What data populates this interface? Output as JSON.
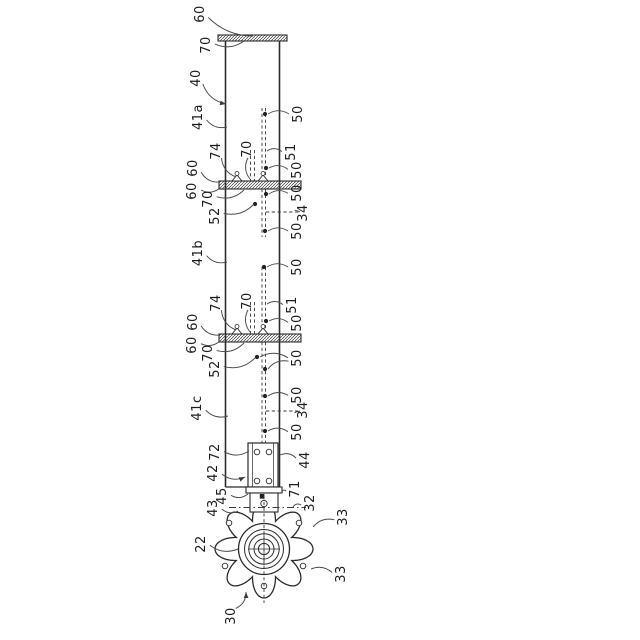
{
  "figure": {
    "kind": "patent-line-drawing",
    "orientation_note": "reference numerals rotated 90deg CCW",
    "background": "#ffffff",
    "line_color": "#2b2b2b",
    "leader_color": "#4a4a4a"
  },
  "labels": [
    {
      "t": "60",
      "x": 200,
      "y": 14,
      "tx": 253,
      "ty": 36
    },
    {
      "t": "70",
      "x": 206,
      "y": 45,
      "tx": 244,
      "ty": 41
    },
    {
      "t": "40",
      "x": 196,
      "y": 78,
      "tx": 226,
      "ty": 104,
      "arrow": true
    },
    {
      "t": "41a",
      "x": 198,
      "y": 117,
      "tx": 227,
      "ty": 127
    },
    {
      "t": "74",
      "x": 216,
      "y": 151,
      "tx": 236,
      "ty": 177
    },
    {
      "t": "70",
      "x": 247,
      "y": 149,
      "tx": 250,
      "ty": 179
    },
    {
      "t": "60",
      "x": 193,
      "y": 168,
      "tx": 220,
      "ty": 182
    },
    {
      "t": "60",
      "x": 192,
      "y": 191,
      "tx": 220,
      "ty": 188
    },
    {
      "t": "70",
      "x": 208,
      "y": 199,
      "tx": 244,
      "ty": 190
    },
    {
      "t": "52",
      "x": 215,
      "y": 216,
      "tx": 254,
      "ty": 204
    },
    {
      "t": "41b",
      "x": 198,
      "y": 253,
      "tx": 227,
      "ty": 262
    },
    {
      "t": "74",
      "x": 216,
      "y": 303,
      "tx": 236,
      "ty": 330
    },
    {
      "t": "70",
      "x": 247,
      "y": 301,
      "tx": 250,
      "ty": 332
    },
    {
      "t": "60",
      "x": 193,
      "y": 322,
      "tx": 220,
      "ty": 335
    },
    {
      "t": "60",
      "x": 192,
      "y": 345,
      "tx": 220,
      "ty": 341
    },
    {
      "t": "70",
      "x": 208,
      "y": 353,
      "tx": 244,
      "ty": 343
    },
    {
      "t": "52",
      "x": 215,
      "y": 369,
      "tx": 255,
      "ty": 358
    },
    {
      "t": "41c",
      "x": 197,
      "y": 408,
      "tx": 228,
      "ty": 416
    },
    {
      "t": "72",
      "x": 215,
      "y": 452,
      "tx": 249,
      "ty": 451
    },
    {
      "t": "42",
      "x": 213,
      "y": 473,
      "tx": 245,
      "ty": 477,
      "arrow": true
    },
    {
      "t": "45",
      "x": 222,
      "y": 496,
      "tx": 248,
      "ty": 494
    },
    {
      "t": "43",
      "x": 213,
      "y": 508,
      "tx": 238,
      "ty": 511
    },
    {
      "t": "22",
      "x": 201,
      "y": 544,
      "tx": 238,
      "ty": 549
    },
    {
      "t": "30",
      "x": 231,
      "y": 616,
      "tx": 246,
      "ty": 592,
      "arrow": true
    },
    {
      "t": "50",
      "x": 298,
      "y": 114,
      "tx": 268,
      "ty": 114
    },
    {
      "t": "51",
      "x": 291,
      "y": 152,
      "tx": 267,
      "ty": 151
    },
    {
      "t": "50",
      "x": 297,
      "y": 170,
      "tx": 269,
      "ty": 168
    },
    {
      "t": "50",
      "x": 297,
      "y": 193,
      "tx": 269,
      "ty": 194
    },
    {
      "t": "34",
      "x": 303,
      "y": 213,
      "tx": 300,
      "ty": 212
    },
    {
      "t": "50",
      "x": 297,
      "y": 231,
      "tx": 268,
      "ty": 231
    },
    {
      "t": "50",
      "x": 297,
      "y": 267,
      "tx": 267,
      "ty": 267
    },
    {
      "t": "51",
      "x": 292,
      "y": 305,
      "tx": 267,
      "ty": 304
    },
    {
      "t": "50",
      "x": 297,
      "y": 323,
      "tx": 269,
      "ty": 321
    },
    {
      "t": "50",
      "x": 297,
      "y": 358,
      "tx": 268,
      "ty": 369,
      "branch": [
        260,
        357
      ]
    },
    {
      "t": "50",
      "x": 297,
      "y": 395,
      "tx": 268,
      "ty": 396
    },
    {
      "t": "34",
      "x": 303,
      "y": 410,
      "tx": 300,
      "ty": 411
    },
    {
      "t": "50",
      "x": 297,
      "y": 432,
      "tx": 268,
      "ty": 431
    },
    {
      "t": "44",
      "x": 305,
      "y": 460,
      "tx": 280,
      "ty": 455
    },
    {
      "t": "71",
      "x": 295,
      "y": 489,
      "tx": 282,
      "ty": 492
    },
    {
      "t": "32",
      "x": 310,
      "y": 503,
      "tx": 293,
      "ty": 507
    },
    {
      "t": "33",
      "x": 343,
      "y": 517,
      "tx": 313,
      "ty": 527
    },
    {
      "t": "33",
      "x": 341,
      "y": 574,
      "tx": 311,
      "ty": 569
    }
  ],
  "anchor_dots": [
    [
      265,
      114
    ],
    [
      266,
      168
    ],
    [
      266,
      194
    ],
    [
      255,
      204
    ],
    [
      265,
      231
    ],
    [
      264,
      267
    ],
    [
      266,
      321
    ],
    [
      257,
      357
    ],
    [
      265,
      369
    ],
    [
      265,
      396
    ],
    [
      265,
      431
    ]
  ],
  "gear": {
    "cx": 264,
    "cy": 549,
    "tip_radius": 49,
    "valley_radius": 30,
    "lobes": 8,
    "hub_radii": [
      25.5,
      19.5,
      15.2,
      10,
      5.6
    ],
    "hole_offsets": [
      [
        -35,
        -26
      ],
      [
        35,
        -26
      ],
      [
        -39,
        17
      ],
      [
        39,
        17
      ],
      [
        0,
        37
      ]
    ],
    "hole_radius": 2.8
  }
}
